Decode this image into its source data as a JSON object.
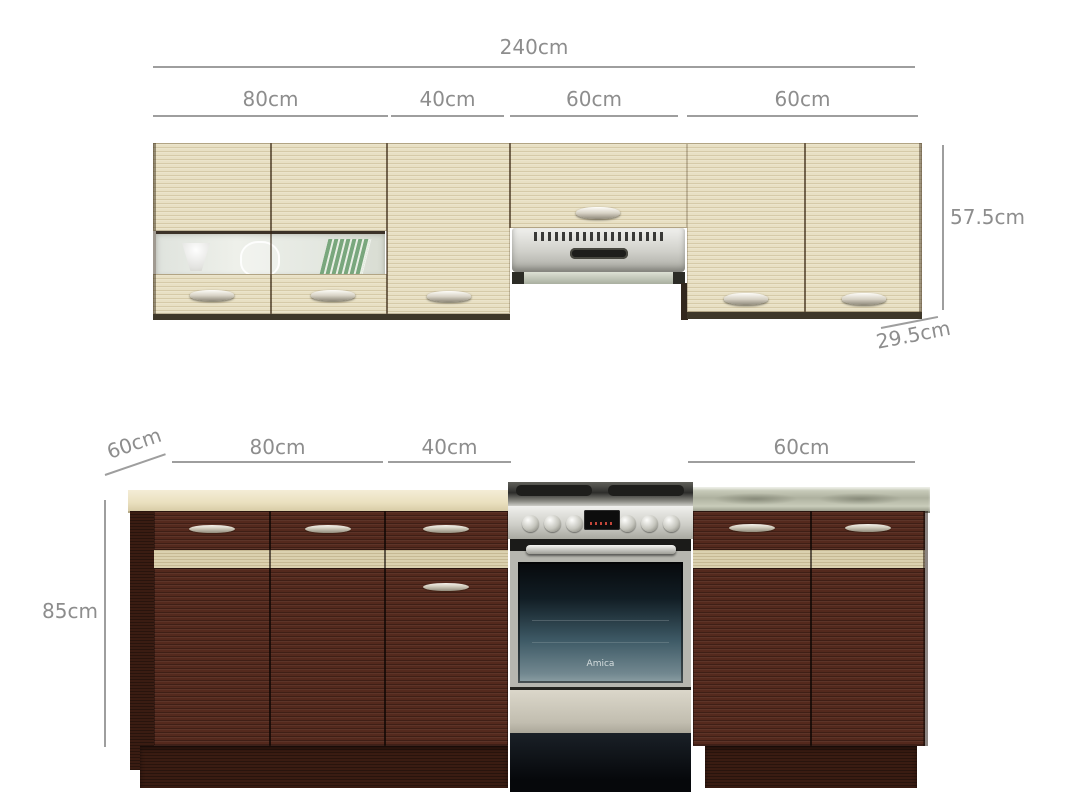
{
  "title": "Kitchen cabinet set with dimensions",
  "dimensions": {
    "upper_total": "240cm",
    "upper_segments": [
      "80cm",
      "40cm",
      "60cm",
      "60cm"
    ],
    "upper_height": "57.5cm",
    "upper_depth": "29.5cm",
    "lower_depth": "60cm",
    "lower_segments": [
      "80cm",
      "40cm",
      "60cm"
    ],
    "lower_height": "85cm"
  },
  "appliances": {
    "oven_brand": "Amica"
  },
  "colors": {
    "background": "#ffffff",
    "dimension_line": "#9e9e9e",
    "dimension_text": "#8d8d8d",
    "upper_wood": "#e8e0c4",
    "lower_wood": "#54291d",
    "accent_strip": "#dbd1af",
    "countertop": "#eee6cc",
    "stainless": "#c9c9c4",
    "oven_glass": "#3e5a66"
  }
}
